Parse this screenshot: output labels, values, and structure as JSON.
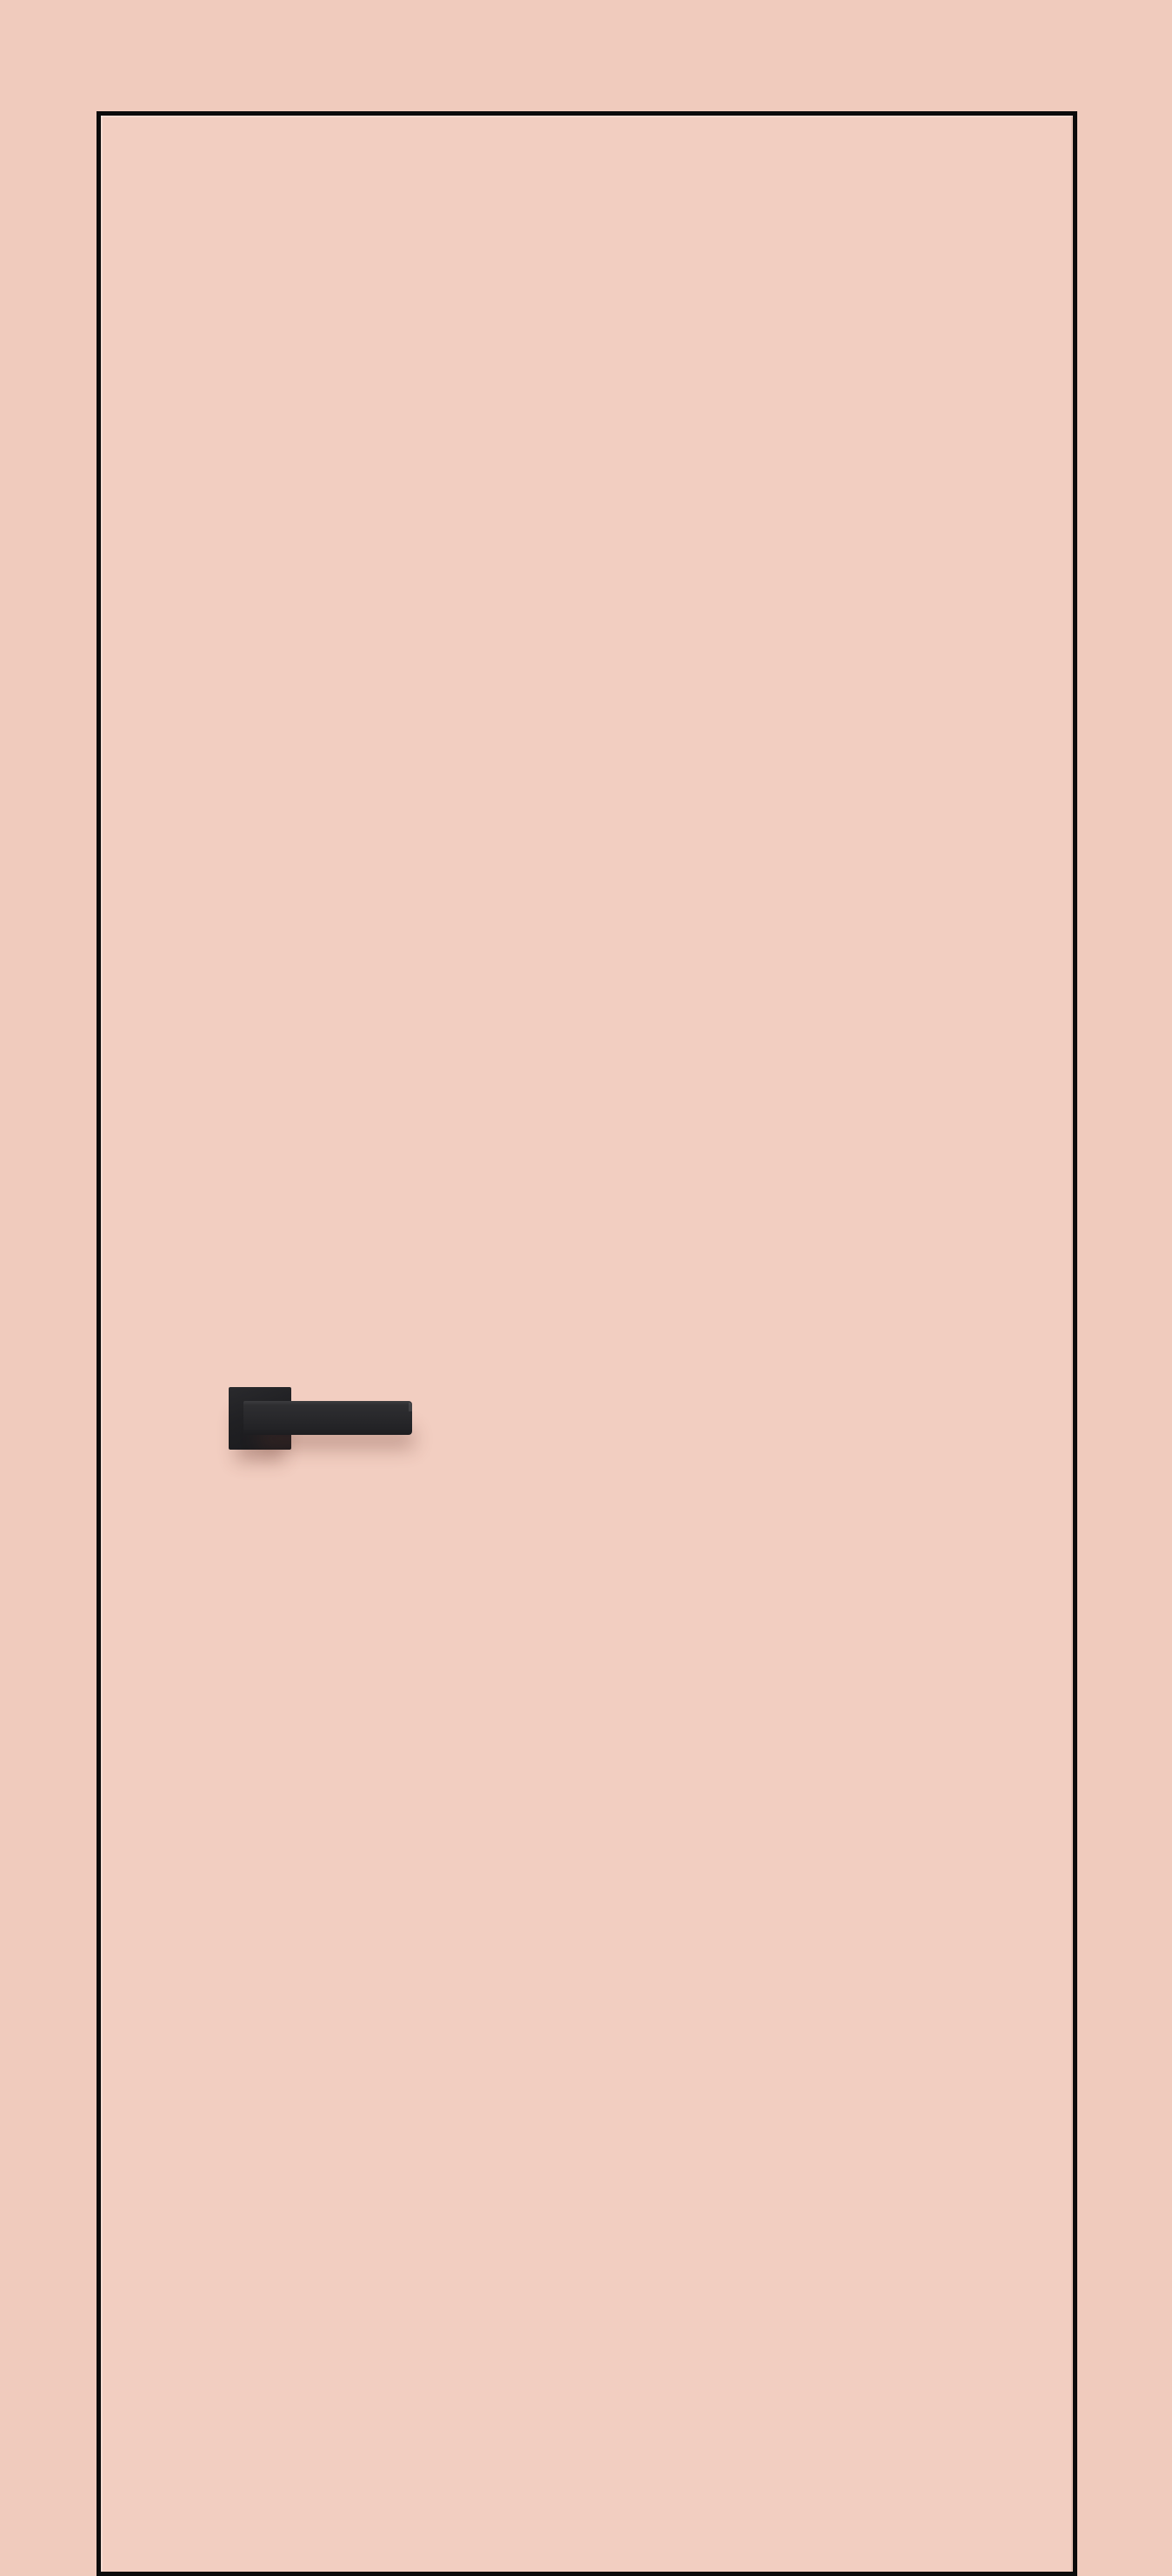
{
  "scene": {
    "description": "Flush interior door in a peach-rose finish with a thin black edge trim and a matte black square-rosette lever handle on the left side, shown on a matching peach background",
    "objects": {
      "door_leaf": "flush door leaf with black edge trim",
      "door_handle": "matte black lever handle on square rosette"
    },
    "colors": {
      "bg": "#f0cbbd",
      "door-face": "#f2cec1",
      "trim": "#0b0b0b",
      "rosette": "#202023",
      "lever": "#29292c",
      "lever-highlight": "#3c3c3f",
      "shadow": "rgba(100, 52, 42, 0.32)"
    }
  }
}
